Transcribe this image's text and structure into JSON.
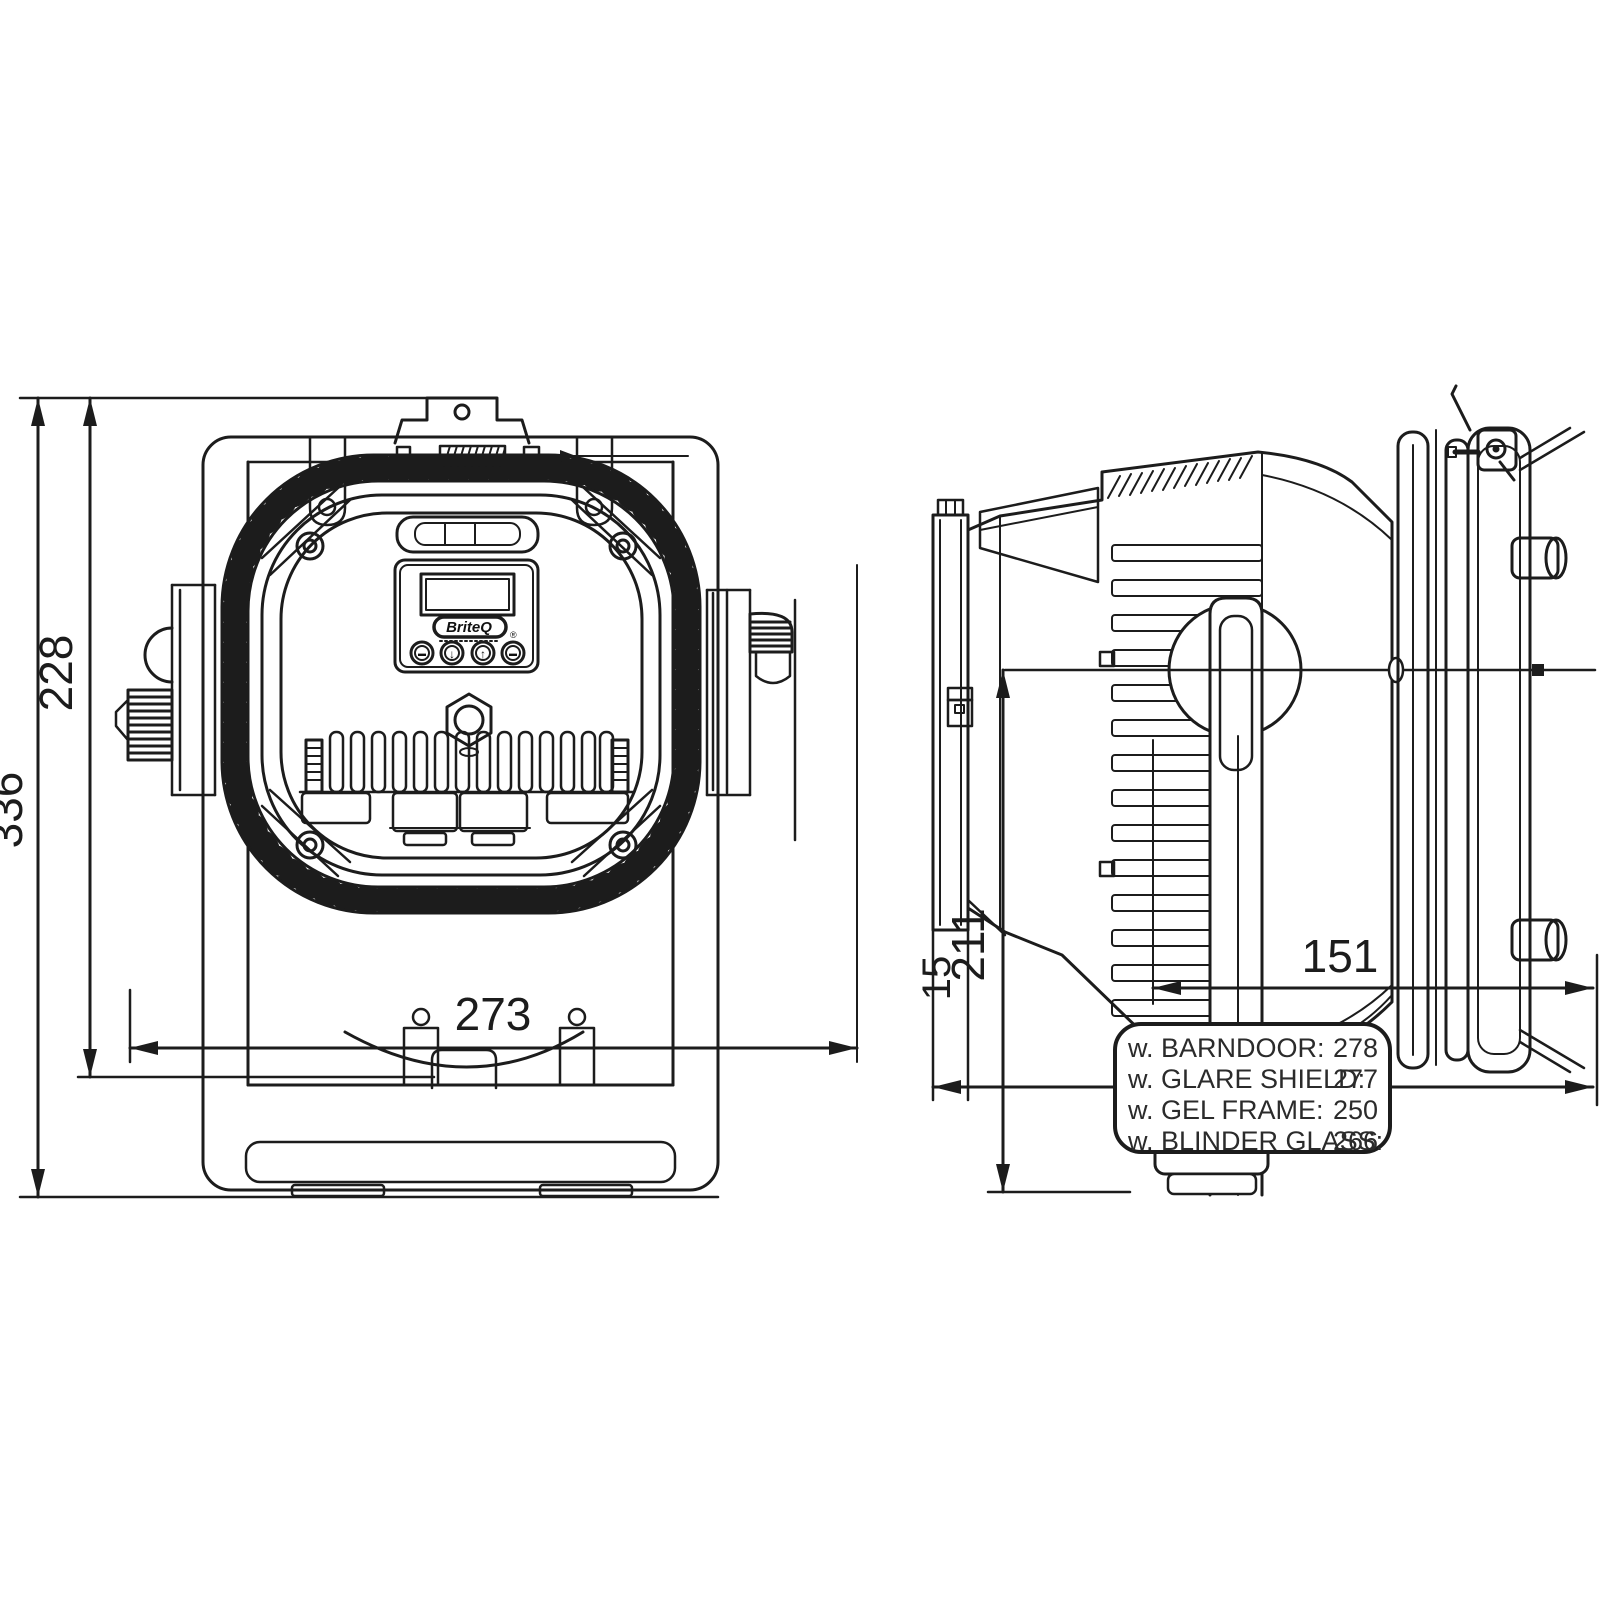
{
  "colors": {
    "line": "#1c1c1c",
    "background": "#ffffff",
    "text": "#2b2b2b"
  },
  "front_view": {
    "dims": {
      "total_height": "336",
      "body_height": "228",
      "width": "273"
    },
    "control_panel": {
      "logo": "BriteQ",
      "registered": "®",
      "buttons": [
        {
          "name": "menu-button",
          "glyph": "▬"
        },
        {
          "name": "down-button",
          "glyph": "↓"
        },
        {
          "name": "up-button",
          "glyph": "↑"
        },
        {
          "name": "enter-button",
          "glyph": "▬"
        }
      ]
    }
  },
  "side_view": {
    "dims": {
      "rear_offset": "15",
      "yoke_height": "211",
      "front_length": "151"
    }
  },
  "spec_box": {
    "rows": [
      {
        "label": "w. BARNDOOR:",
        "value": "278"
      },
      {
        "label": "w. GLARE SHIELD:",
        "value": "277"
      },
      {
        "label": "w. GEL FRAME:",
        "value": "250"
      },
      {
        "label": "w. BLINDER GLASS:",
        "value": "266"
      }
    ]
  }
}
